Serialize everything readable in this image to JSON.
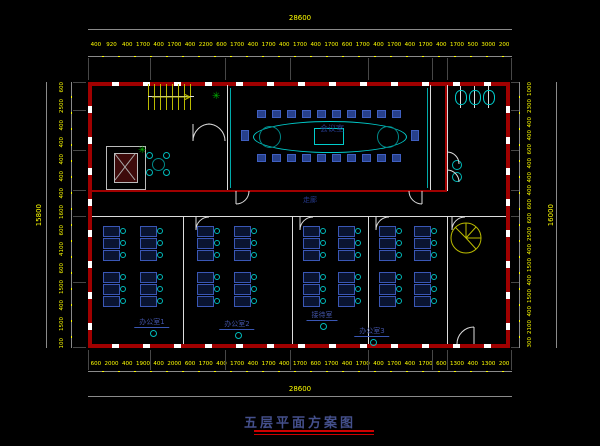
{
  "title": {
    "text": "五层平面方案图"
  },
  "rooms": {
    "conference": "会议室",
    "corridor": "走廊",
    "office1": "办公室1",
    "office2": "办公室2",
    "office3": "接待室",
    "office4": "办公室3"
  },
  "dimensions": {
    "top_total": "28600",
    "bottom_total": "28600",
    "left_total": "15800",
    "right_total": "16000",
    "top_chain": [
      "400",
      "920",
      "400",
      "1700",
      "400",
      "1700",
      "400",
      "2200",
      "600",
      "1700",
      "400",
      "1700",
      "400",
      "1700",
      "400",
      "1700",
      "600",
      "1700",
      "400",
      "1700",
      "400",
      "1700",
      "400",
      "1700",
      "500",
      "3000",
      "200"
    ],
    "bottom_chain": [
      "600",
      "2000",
      "400",
      "1900",
      "400",
      "2000",
      "600",
      "1700",
      "400",
      "1700",
      "400",
      "1700",
      "400",
      "1700",
      "600",
      "1700",
      "400",
      "1700",
      "400",
      "1700",
      "400",
      "1700",
      "600",
      "1300",
      "400",
      "1300",
      "200"
    ],
    "left_chain": [
      "600",
      "2500",
      "400",
      "400",
      "400",
      "400",
      "400",
      "1600",
      "600",
      "4100",
      "600",
      "1500",
      "400",
      "1500",
      "100"
    ],
    "right_chain": [
      "1000",
      "2300",
      "400",
      "400",
      "600",
      "400",
      "400",
      "400",
      "600",
      "600",
      "2500",
      "400",
      "1500",
      "400",
      "1500",
      "400",
      "2100",
      "300"
    ]
  },
  "colors": {
    "background": "#000000",
    "wall_red": "#a00000",
    "dimension_yellow": "#ffff00",
    "furniture_cyan": "#00cccc",
    "desk_blue": "#3a57b5",
    "label_blue": "#4254a8",
    "plant_green": "#00aa00",
    "stair_yellow": "#bbbb00"
  }
}
